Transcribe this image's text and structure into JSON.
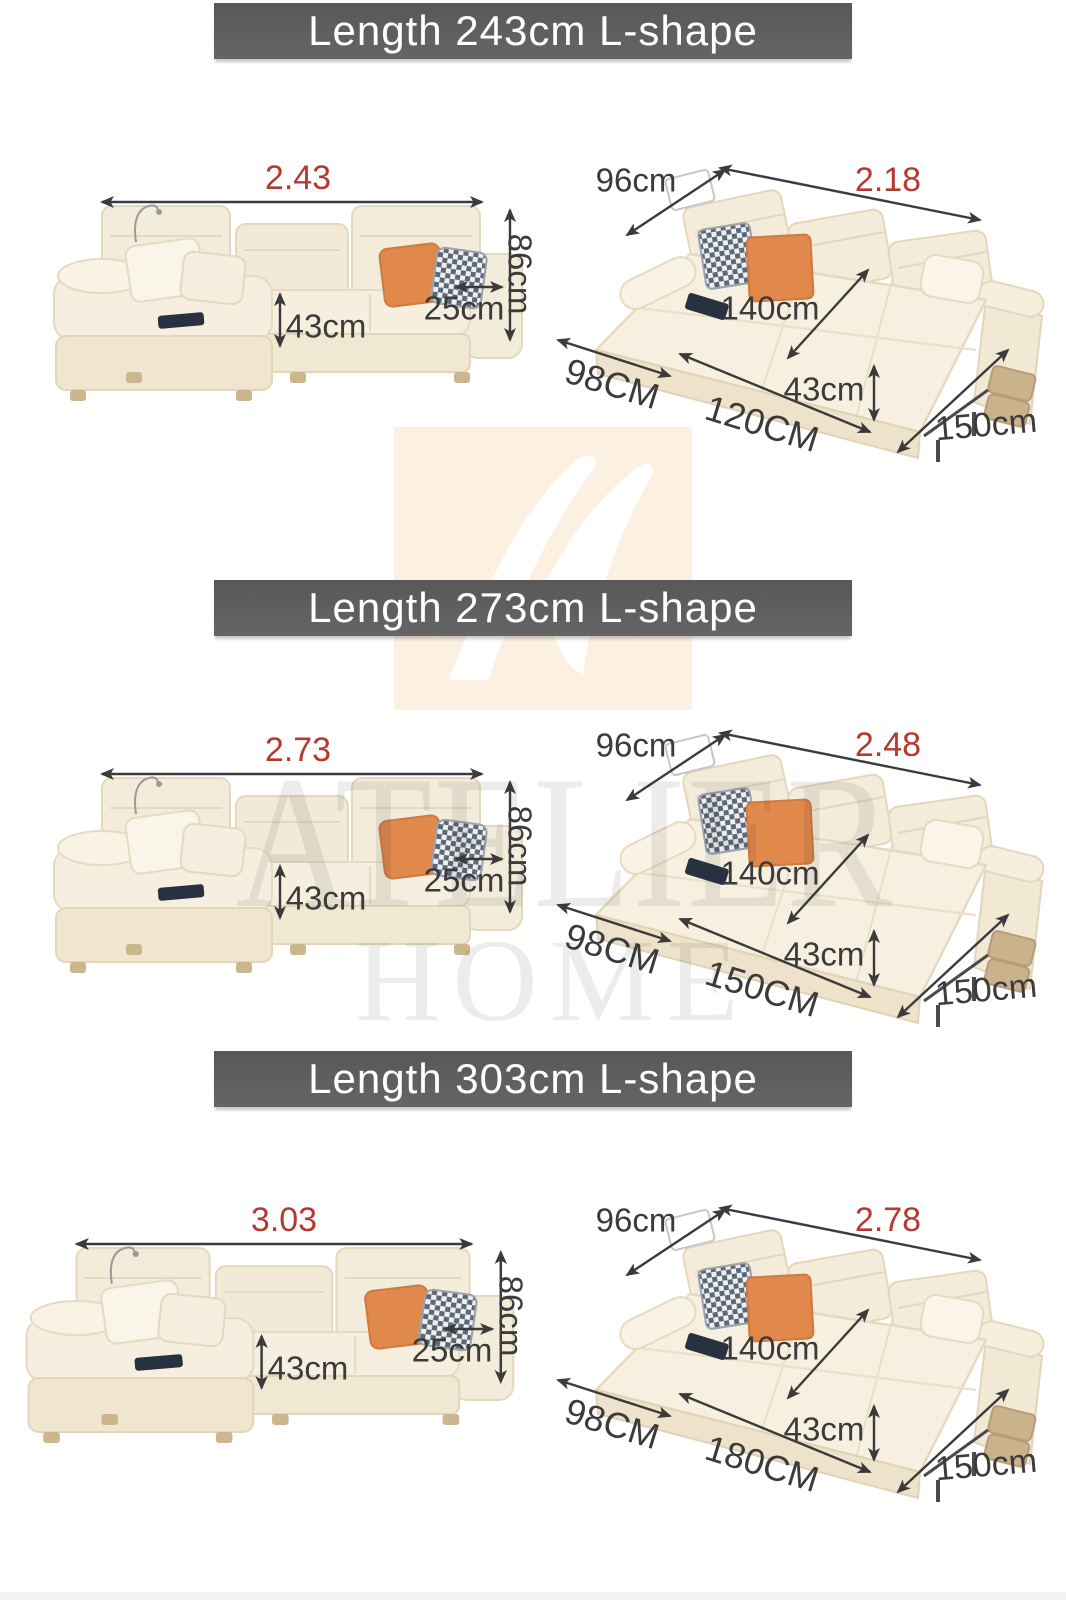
{
  "page": {
    "width": 1066,
    "height": 1600,
    "background": "#ffffff"
  },
  "colors": {
    "banner_background": "#5d5d5d",
    "banner_text": "#ffffff",
    "dimension_text": "#3b3b3b",
    "accent_red": "#b43a30",
    "sofa_cream": "#f5eedc",
    "pillow_orange": "#e1884d",
    "watermark_peach": "#fcf0e1"
  },
  "watermark": {
    "logo_letter": "A",
    "line1": "ATELIER",
    "line2": "HOME"
  },
  "sections": [
    {
      "title": "Length 243cm L-shape",
      "front": {
        "total_length": "2.43",
        "height": "86cm",
        "armrest_width": "25cm",
        "seat_height": "43cm"
      },
      "bed": {
        "backrest_depth": "96cm",
        "total_length": "2.18",
        "bed_width": "140cm",
        "chaise_width": "98CM",
        "middle_width": "120CM",
        "seat_height": "43cm",
        "bed_depth": "150cm"
      }
    },
    {
      "title": "Length 273cm L-shape",
      "front": {
        "total_length": "2.73",
        "height": "86cm",
        "armrest_width": "25cm",
        "seat_height": "43cm"
      },
      "bed": {
        "backrest_depth": "96cm",
        "total_length": "2.48",
        "bed_width": "140cm",
        "chaise_width": "98CM",
        "middle_width": "150CM",
        "seat_height": "43cm",
        "bed_depth": "150cm"
      }
    },
    {
      "title": "Length 303cm L-shape",
      "front": {
        "total_length": "3.03",
        "height": "86cm",
        "armrest_width": "25cm",
        "seat_height": "43cm"
      },
      "bed": {
        "backrest_depth": "96cm",
        "total_length": "2.78",
        "bed_width": "140cm",
        "chaise_width": "98CM",
        "middle_width": "180CM",
        "seat_height": "43cm",
        "bed_depth": "150cm"
      }
    }
  ]
}
